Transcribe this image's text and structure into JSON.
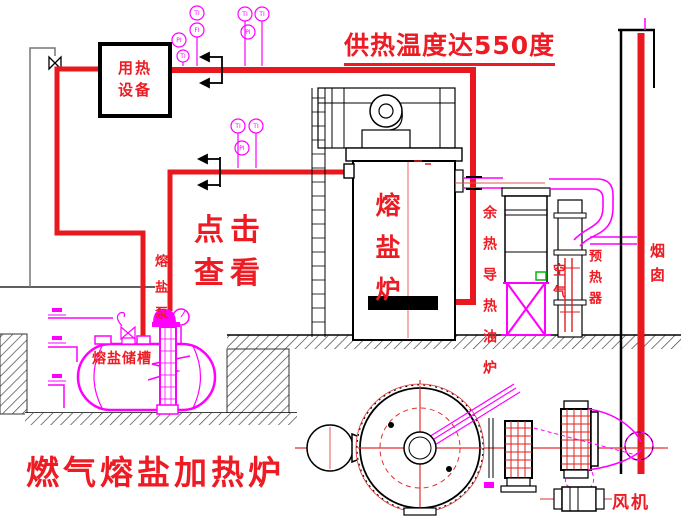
{
  "banner": {
    "text": "供热温度达550度"
  },
  "heat_user": {
    "line1": "用热",
    "line2": "设备"
  },
  "click_hint": {
    "line1": "点击",
    "line2": "查看"
  },
  "labels": {
    "furnace": "熔盐炉",
    "waste_heat_furnace": "余热导热油炉",
    "air": "空气",
    "preheater": "预热器",
    "chimney": "烟囱",
    "pump": "熔盐泵",
    "tank": "熔盐储槽",
    "fan": "风机"
  },
  "caption": {
    "text": "燃气熔盐加热炉"
  },
  "instruments": [
    "TI",
    "FI",
    "PI",
    "TI",
    "TI",
    "PI",
    "TI",
    "TI",
    "PI",
    "TI"
  ],
  "colors": {
    "text_red": "#ed1b23",
    "pipe_red": "#e8181e",
    "magenta": "#ff00ff",
    "line_black": "#000000",
    "green": "#00bb00"
  }
}
